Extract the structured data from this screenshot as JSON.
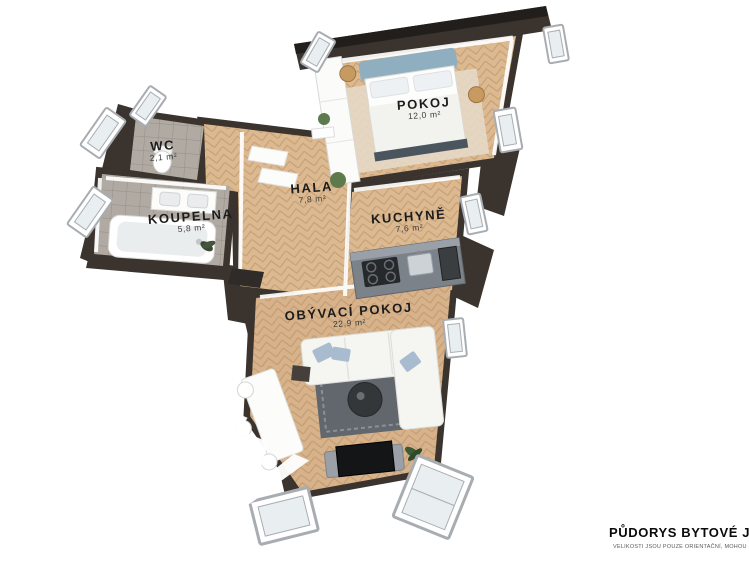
{
  "scene": {
    "description": "3D rendered apartment floor plan, top-down axonometric view",
    "watermark": "ity"
  },
  "rooms": [
    {
      "id": "pokoj",
      "name": "POKOJ",
      "area": "12,0 m²"
    },
    {
      "id": "wc",
      "name": "WC",
      "area": "2,1 m²"
    },
    {
      "id": "koupelna",
      "name": "KOUPELNA",
      "area": "5,8 m²"
    },
    {
      "id": "hala",
      "name": "HALA",
      "area": "7,8 m²"
    },
    {
      "id": "kuchyne",
      "name": "KUCHYNĚ",
      "area": "7,6 m²"
    },
    {
      "id": "obyvaci_pokoj",
      "name": "OBÝVACÍ POKOJ",
      "area": "22,9 m²"
    }
  ],
  "footer": {
    "title": "PŮDORYS BYTOVÉ JEDNOTKY",
    "disclaimer": "VELIKOSTI JSOU POUZE ORIENTAČNÍ, MOHOU SE LIŠIT"
  },
  "palette": {
    "wall-dark": "#3a332e",
    "wall-top": "#221e1b",
    "wood": "#dcb990",
    "wood-line": "#c6a176",
    "tile": "#b0aaa3",
    "tile-line": "#968e87",
    "frame": "#a8adb2",
    "glass": "#e9eef1",
    "accent-blue": "#8fafc1",
    "pillow-blue": "#a9bccf",
    "rug-dark": "#62666d",
    "rug-light": "#8b9097",
    "counter": "#7c828a",
    "plant": "#5d7a4c",
    "wood-table": "#c79a62",
    "ink": "#1c1c1c",
    "watermark": "#ffffff"
  }
}
